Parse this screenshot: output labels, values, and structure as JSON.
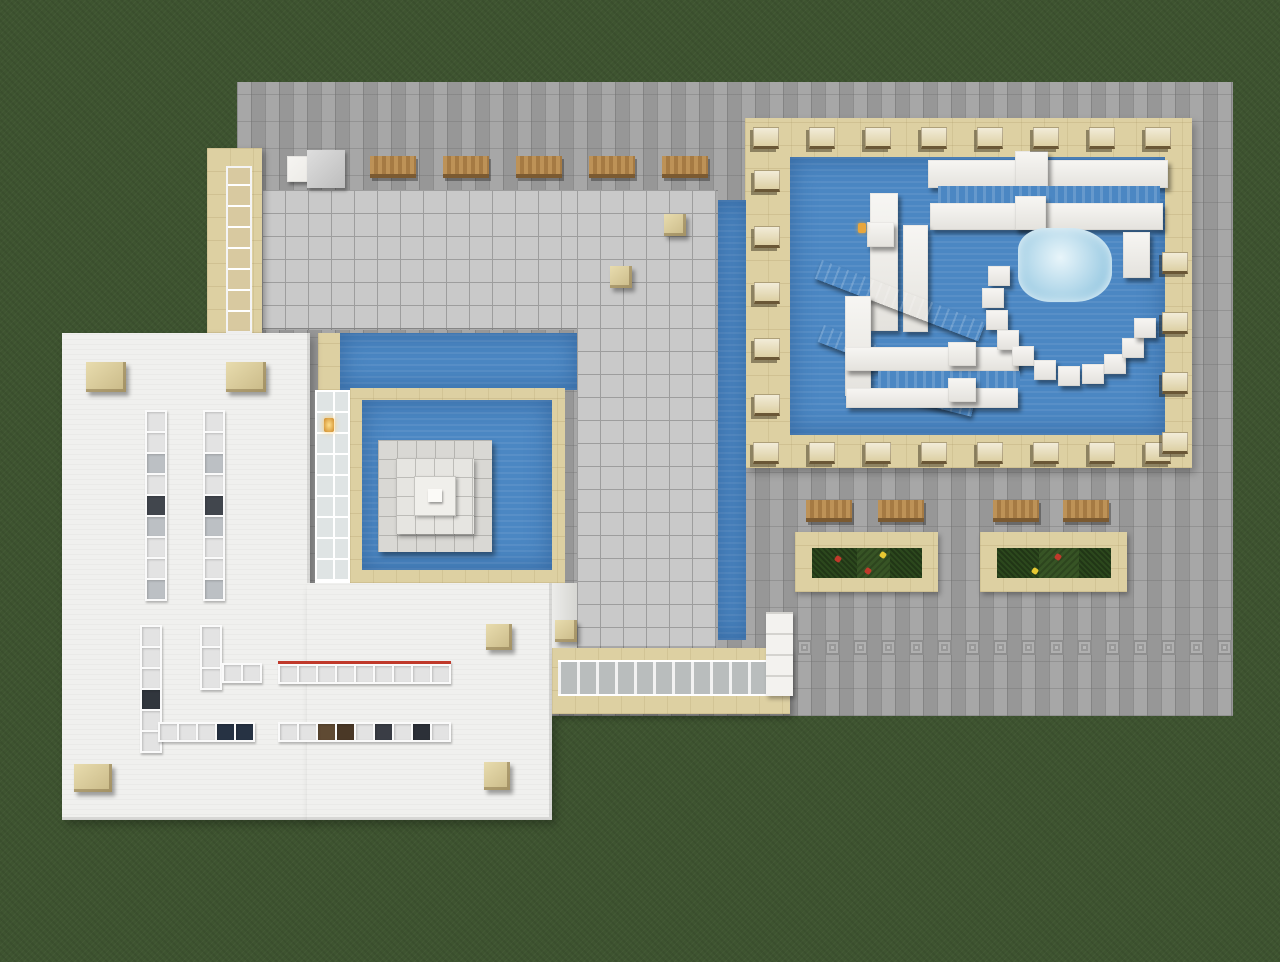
{
  "scene": {
    "type": "minecraft-aerial-screenshot",
    "view": "top-down view of a voxel pool / leisure-center build on grass",
    "regions": {
      "plaza": "large gray stone-brick paved plaza",
      "pool_deck": "sandstone deck with large blue pool and white quartz water slides, ringed by lounge chairs",
      "roof_hall": "L-shaped light gray tiled roof with water channels along its edges",
      "courtyard": "sandstone-framed pool with stepped quartz fountain and glass-block wall",
      "white_building": "flat white roof with rows of skylights and sandstone corner blocks",
      "atrium_facade": "sandstone south wall with a band of framed glass windows",
      "gardens": "two sandstone planter beds with dark hedges and flowers, wooden benches beside"
    },
    "counts": {
      "deck_loungers_top": 8,
      "deck_loungers_bottom": 8,
      "deck_loungers_left": 5,
      "deck_loungers_right": 4,
      "plaza_benches_top": 5,
      "garden_benches": 4,
      "garden_beds": 2,
      "decor_motif_tiles": 16,
      "skylight_strips": 7,
      "fountain_tiers": 3,
      "slide_hook_blocks": 11
    }
  },
  "colors": {
    "grass": "#3e5430",
    "plaza": "#a0a0a0",
    "sandstone": "#ddd0a2",
    "water": "#4b87c3",
    "quartz": "#eceae6",
    "tile": "#c9c9c9",
    "tile_line": "#9d9d9d",
    "white_roof": "#f0f0ee",
    "glass": "#dfe4e4",
    "ice": "#9fcde4",
    "ramp": "#565656",
    "leaves": "#2c481d",
    "bed_grass": "#375425",
    "red_line": "#c0392b",
    "flower_red": "#c0392b",
    "flower_yellow": "#e7c832",
    "gold": "#e8a63c"
  }
}
